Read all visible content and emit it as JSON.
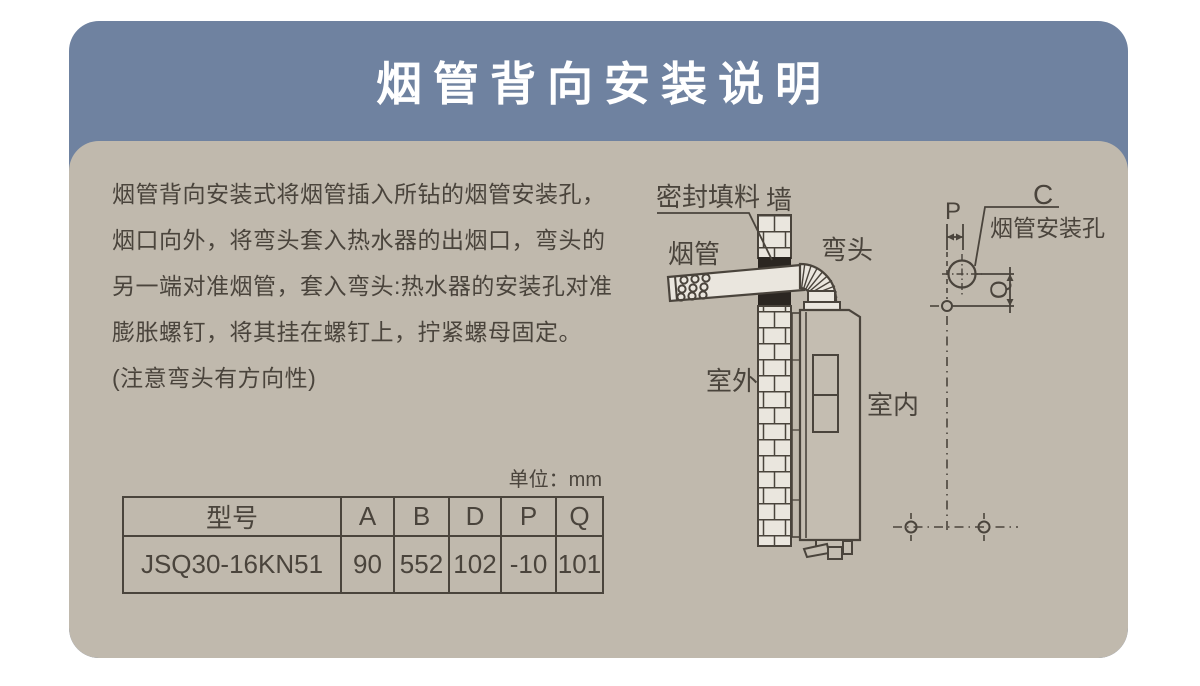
{
  "title": "烟管背向安装说明",
  "description": {
    "lines": [
      "烟管背向安装式将烟管插入所钻的烟管安装孔，",
      "烟口向外，将弯头套入热水器的出烟口，弯头的",
      "另一端对准烟管，套入弯头:热水器的安装孔对准",
      "膨胀螺钉，将其挂在螺钉上，拧紧螺母固定。",
      "(注意弯头有方向性)"
    ]
  },
  "spec_table": {
    "unit_label": "单位：mm",
    "headers": [
      "型号",
      "A",
      "B",
      "D",
      "P",
      "Q"
    ],
    "rows": [
      [
        "JSQ30-16KN51",
        "90",
        "552",
        "102",
        "-10",
        "101"
      ]
    ]
  },
  "diagram": {
    "labels": {
      "sealing": "密封填料",
      "wall": "墙",
      "pipe": "烟管",
      "elbow": "弯头",
      "outdoor": "室外",
      "indoor": "室内",
      "dim_c": "C",
      "dim_p": "P",
      "dim_q": "Q",
      "hole": "烟管安装孔"
    }
  },
  "colors": {
    "header_bg": "#6f82a0",
    "body_bg": "#c0b9ad",
    "ink": "#4a443c",
    "seal_black": "#2b2621",
    "fill_light": "#eae6de",
    "title_text": "#ffffff"
  }
}
